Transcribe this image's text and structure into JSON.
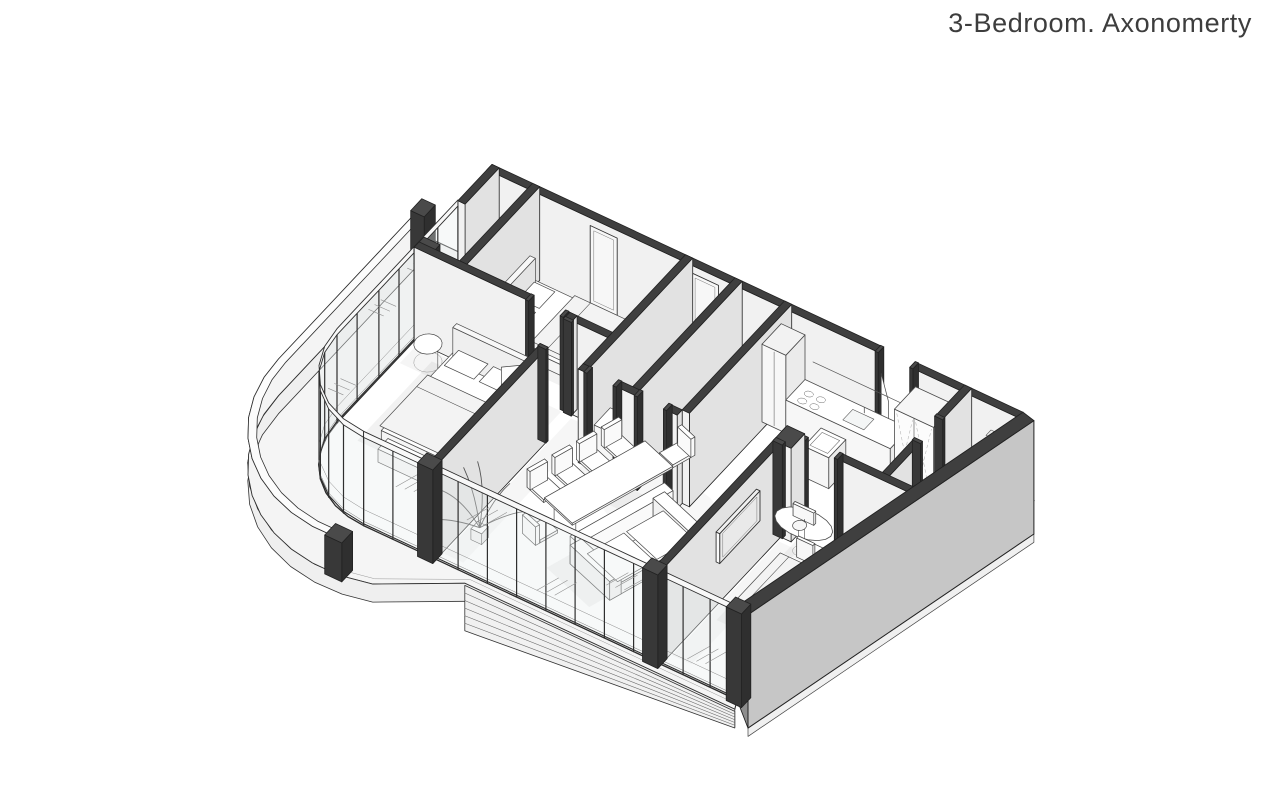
{
  "title": "3-Bedroom. Axonomerty",
  "drawing": {
    "kind": "axonometric-floor-plan-cutaway",
    "rooms": [
      "bedroom-1",
      "bedroom-2",
      "bedroom-3",
      "bathroom-1",
      "bathroom-2",
      "bathroom-3",
      "kitchen",
      "living-dining",
      "entry-hall",
      "balcony"
    ]
  },
  "palette": {
    "background": "#ffffff",
    "line": "#2e2e2e",
    "wallTop": "#3f3f3f",
    "wallFace": "#f1f1f1",
    "wallSide": "#e2e2e2",
    "capTop": "#4a4a4a",
    "capFront": "#383838",
    "capSide": "#2f2f2f",
    "floor": "#ffffff",
    "slab": "#f5f5f5",
    "fascia": "#efefef",
    "parapet": "#f4f4f4",
    "partyWall": "#c6c6c6",
    "partyEnd": "#8e8e8e",
    "glassTick": "#8f8f8f",
    "pane": "#e9eded",
    "furn": "#ffffff",
    "furnLine": "#4a4a4a",
    "soft": "#f3f3f3",
    "shadow": "#000000"
  }
}
